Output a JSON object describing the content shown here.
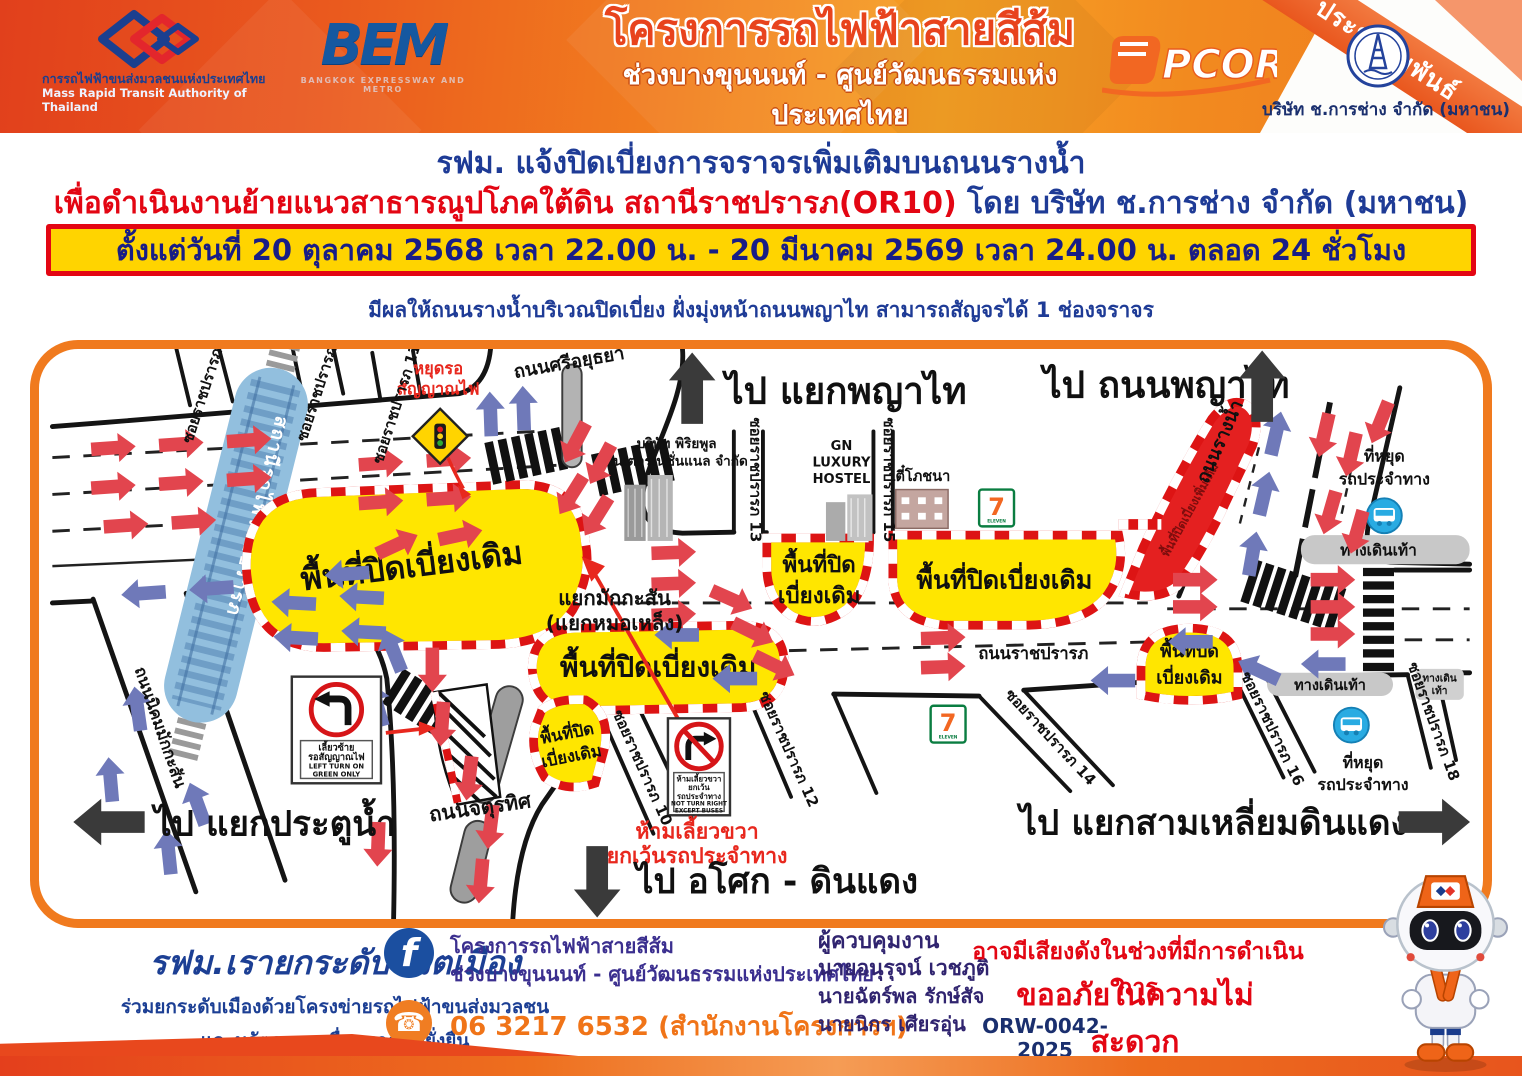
{
  "colors": {
    "header_orange": "#ef6f1e",
    "accent_red": "#e30613",
    "navy_text": "#1e3b96",
    "banner_yellow": "#ffd400",
    "closure_yellow": "#ffe600",
    "closure_new_red": "#e42020",
    "arrow_red": "#e2454e",
    "arrow_blue": "#6f79b9",
    "railway_blue": "#92bfde"
  },
  "header": {
    "mrta_logo_th": "การรถไฟฟ้าขนส่งมวลชนแห่งประเทศไทย",
    "mrta_logo_en": "Mass Rapid Transit Authority of Thailand",
    "bem_logo": "BEM",
    "bem_logo_sub": "BANGKOK EXPRESSWAY AND METRO",
    "project_title": "โครงการรถไฟฟ้าสายสีส้ม",
    "project_subtitle": "ช่วงบางขุนนนท์ - ศูนย์วัฒนธรรมแห่งประเทศไทย",
    "pcor_logo": "PCOR",
    "contractor": "บริษัท ช.การช่าง จำกัด (มหาชน)",
    "ribbon": "ประชาสัมพันธ์"
  },
  "announcement": {
    "headline": "รฟม. แจ้งปิดเบี่ยงการจราจรเพิ่มเติมบนถนนรางน้ำ",
    "headline2_red": "เพื่อดำเนินงานย้ายแนวสาธารณูปโภคใต้ดิน สถานีราชปรารภ(OR10)",
    "headline2_blue": " โดย บริษัท ช.การช่าง จำกัด (มหาชน)",
    "period": "ตั้งแต่วันที่ 20 ตุลาคม 2568 เวลา 22.00 น. - 20 มีนาคม 2569 เวลา 24.00 น. ตลอด 24 ชั่วโมง",
    "effect": "มีผลให้ถนนรางน้ำบริเวณปิดเบี่ยง ฝั่งมุ่งหน้าถนนพญาไท สามารถสัญจรได้ 1 ช่องจราจร"
  },
  "map": {
    "directions": {
      "phayathai_junction": "ไป แยกพญาไท",
      "phayathai_road": "ไป ถนนพญาไท",
      "pratunam": "ไป แยกประตูน้ำ",
      "asok_dindaeng": "ไป อโศก - ดินแดง",
      "samliam_dindaeng": "ไป แยกสามเหลี่ยมดินแดง"
    },
    "roads": {
      "si_ayutthaya": "ถนนศรีอยุธยา",
      "nikhom_makkasan": "ถนนนิคมมักกะสัน",
      "chaturathit": "ถนนจตุรทิศ",
      "ratchaprarop": "ถนนราชปรารภ",
      "rang_nam": "ถนนรางน้ำ",
      "railway_station": "สถานีรถไฟราชปรารภ",
      "soi7": "ซอยราชปรารภ 7",
      "soi9": "ซอยราชปรารภ 9",
      "soi11": "ซอยราชปรารภ 11",
      "soi13": "ซอยราชปรารภ 13",
      "soi15": "ซอยราชปรารภ 15",
      "soi10": "ซอยราชปรารภ 10",
      "soi12": "ซอยราชปรารภ 12",
      "soi14": "ซอยราชปรารภ 14",
      "soi16": "ซอยราชปรารภ 16",
      "soi18": "ซอยราชปรารภ 18"
    },
    "junction": {
      "line1": "แยกมักกะสัน",
      "line2": "(แยกหมอเหล็ง)"
    },
    "areas": {
      "closure_existing": "พื้นที่ปิดเบี่ยงเดิม",
      "closure_existing_l1": "พื้นที่ปิด",
      "closure_existing_l2": "เบี่ยงเดิม",
      "closure_new": "พื้นที่ปิดเบี่ยงเพิ่มเติม"
    },
    "signs": {
      "wait_signal_l1": "หยุดรอ",
      "wait_signal_l2": "สัญญาณไฟ",
      "left_turn_l1": "เลี้ยวซ้าย",
      "left_turn_l2": "รอสัญญาณไฟ",
      "left_turn_en1": "LEFT TURN ON",
      "left_turn_en2": "GREEN ONLY",
      "no_right_l1": "ห้ามเลี้ยวขวา",
      "no_right_l2": "ยกเว้น",
      "no_right_l3": "รถประจำทาง",
      "no_right_en1": "NOT TURN RIGHT",
      "no_right_en2": "EXCEPT BUSES",
      "no_right_note1": "ห้ามเลี้ยวขวา",
      "no_right_note2": "ยกเว้นรถประจำทาง"
    },
    "pois": {
      "piriyapol_l1": "บริษัท พิริยพูล",
      "piriyapol_l2": "อินเตอร์เนชั่นแนล จำกัด",
      "gn_l1": "GN",
      "gn_l2": "LUXURY",
      "gn_l3": "HOSTEL",
      "tee_pochana": "ตี๋โภชนา",
      "seven": "7",
      "seven_eleven": "ELEVEN",
      "bus_stop_l1": "ที่หยุด",
      "bus_stop_l2": "รถประจำทาง",
      "sidewalk": "ทางเดินเท้า",
      "sidewalk_l1": "ทางเดิน",
      "sidewalk_l2": "เท้า"
    }
  },
  "footer": {
    "slogan": "รฟม.เรายกระดับชีวิตเมือง",
    "slogan_sub1": "ร่วมยกระดับเมืองด้วยโครงข่ายรถไฟฟ้าขนส่งมวลชน",
    "slogan_sub2": "และนวัตกรรม  เพื่ออนาคตที่ยั่งยืน",
    "facebook_f": "f",
    "facebook_l1": "โครงการรถไฟฟ้าสายสีส้ม",
    "facebook_l2": "ช่วงบางขุนนนท์ - ศูนย์วัฒนธรรมแห่งประเทศไทย",
    "phone_glyph": "☎",
    "phone": "06 3217 6532 (สำนักงานโครงการฯ)",
    "supervisors_title": "ผู้ควบคุมงาน",
    "supervisor1": "นายอนุรุจน์ เวชภูติ",
    "supervisor2": "นายฉัตร์พล  รักษ์สัจ",
    "supervisor3": "นายนิกร  เศียรอุ่น",
    "noise_notice": "อาจมีเสียงดังในช่วงที่มีการดำเนินการ",
    "apology": "ขออภัยในความไม่สะดวก",
    "doc_no": "ORW-0042-2025"
  }
}
